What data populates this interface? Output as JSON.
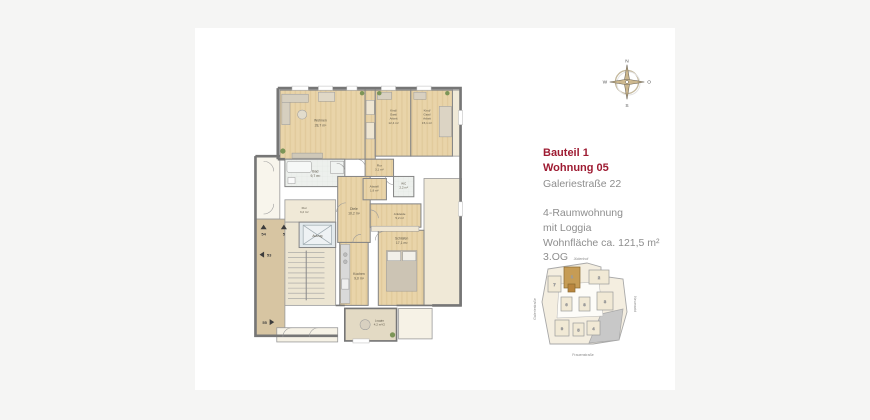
{
  "info": {
    "bauteil": "Bauteil 1",
    "wohnung": "Wohnung 05",
    "street": "Galeriestraße 22",
    "lines": [
      "4-Raumwohnung",
      "mit Loggia",
      "Wohnfläche ca. 121,5 m²",
      "3.OG"
    ],
    "accent_color": "#9e1b32",
    "text_color": "#8e8e8e"
  },
  "compass": {
    "n": "N",
    "o": "O",
    "s": "S",
    "w": "W"
  },
  "floorplan": {
    "elevator": "Aufzug",
    "rooms": [
      {
        "name": "Wohnen",
        "area": "28,7 m²"
      },
      {
        "name": "Kind/",
        "name2": "Gast/",
        "name3": "Arbeit",
        "area": "12,4 m²"
      },
      {
        "name": "Kind/",
        "name2": "Gast/",
        "name3": "Arbeit",
        "area": "15,1 m²"
      },
      {
        "name": "Bad",
        "area": "9,7 m²"
      },
      {
        "name": "Flur",
        "area": "3,1 m²"
      },
      {
        "name": "Abstell",
        "area": "1,9 m²"
      },
      {
        "name": "WC",
        "area": "2,2 m²"
      },
      {
        "name": "Diele",
        "area": "10,2 m²"
      },
      {
        "name": "Ankleide",
        "area": "5,2 m²"
      },
      {
        "name": "Flur",
        "area": "3,2 m²"
      },
      {
        "name": "Schlafen",
        "area": "17,1 m²"
      },
      {
        "name": "Kochen",
        "area": "9,0 m²"
      },
      {
        "name": "Loggia",
        "area": "4,2 m²/2"
      }
    ],
    "markers": [
      {
        "label": "54"
      },
      {
        "label": "5"
      },
      {
        "label": "53"
      },
      {
        "label": "55"
      }
    ]
  },
  "siteplan": {
    "streets": {
      "top": "Jüdenhof",
      "bottom": "Frauenstraße",
      "left": "Galeriestraße",
      "right": "Neumarkt"
    },
    "buildings": [
      "7",
      "1",
      "2",
      "6",
      "8",
      "3",
      "9",
      "5",
      "4"
    ],
    "highlighted": "1"
  }
}
